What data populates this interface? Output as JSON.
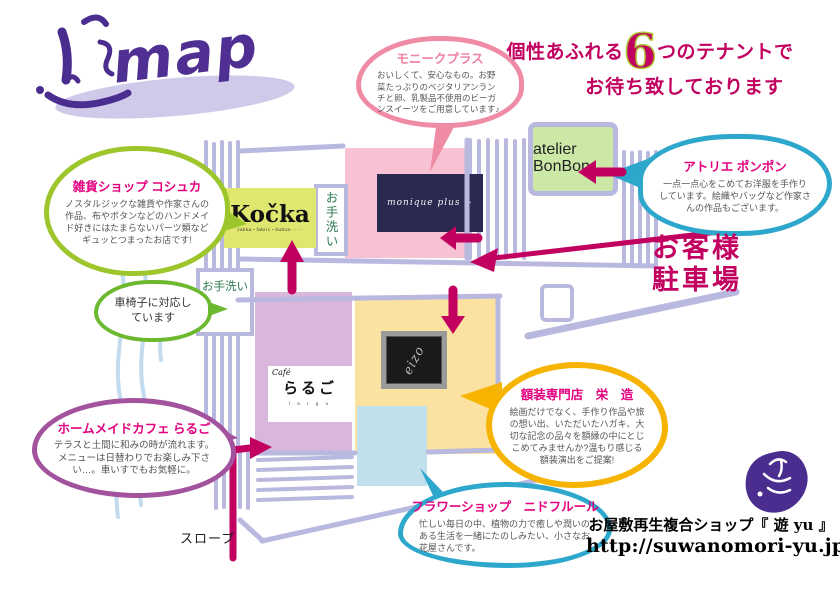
{
  "header": {
    "logo": "map",
    "headline": {
      "part1": "個性あふれる",
      "number": "6",
      "part2": "つのテナントで",
      "line2": "お待ち致しております"
    }
  },
  "bubbles": {
    "monique": {
      "title": "モニークプラス",
      "body": "おいしくて、安心なもの。お野菜たっぷりのベジタリアンランチと卵、乳製品不使用のビーガンスイーツをご用意しています♪",
      "border_color": "#f08ba6"
    },
    "bonbon": {
      "title": "アトリエ ポンポン",
      "body": "一点一点心をこめてお洋服を手作りしています。絵織やバッグなど作家さんの作品もございます。",
      "border_color": "#2ea7cc"
    },
    "koshuka": {
      "title": "雑貨ショップ コシュカ",
      "body": "ノスタルジックな雑貨や作家さんの作品、布やボタンなどのハンドメイド好きにはたまらないパーツ類などギュッとつまったお店です!",
      "border_color": "#9dc62d"
    },
    "wheelchair": {
      "body": "車椅子に対応しています",
      "border_color": "#6cb82f"
    },
    "largo": {
      "title": "ホームメイドカフェ らるご",
      "body": "テラスと土間に和みの時が流れます。メニューは日替わりでお楽しみ下さい…。車いすでもお気軽に。",
      "border_color": "#a3539e"
    },
    "eizo": {
      "title": "額装専門店　栄　造",
      "body": "絵画だけでなく、手作り作品や旅の想い出、いただいたハガキ、大切な記念の品々を額縁の中にとじこめてみませんか?温もり感じる額装演出をご提案!",
      "border_color": "#f6b400"
    },
    "nid": {
      "title": "フラワーショップ　ニドフルール",
      "body": "忙しい毎日の中、植物の力で癒しや潤いのある生活を一緒にたのしみたい、小さなお花屋さんです。",
      "border_color": "#2ea7cc"
    }
  },
  "map": {
    "shops": {
      "kocka": {
        "name": "Kočka",
        "tagline": "zakka・fabric・button ·····"
      },
      "bonbon": {
        "name": "atelier BonBon"
      },
      "monique": {
        "script": "monique plus +"
      },
      "largo": {
        "script": "Café",
        "name": "らるご",
        "tagline": "l a r g o"
      },
      "eizo": {
        "name": "eizo"
      }
    },
    "labels": {
      "restroom_upper": "お手洗い",
      "restroom_lower": "お手洗い",
      "parking_line1": "お客様",
      "parking_line2": "駐車場",
      "slope": "スロープ"
    }
  },
  "footer": {
    "shop_name": "お屋敷再生複合ショップ『 遊 yu 』",
    "url": "http://suwanomori-yu.jp/"
  },
  "colors": {
    "accent_magenta": "#c2005f",
    "bubble_title_pink": "#e4007f",
    "arrow": "#c2005f",
    "outline_lavender": "#b9b8df",
    "stamp_purple": "#4a2d8e"
  }
}
